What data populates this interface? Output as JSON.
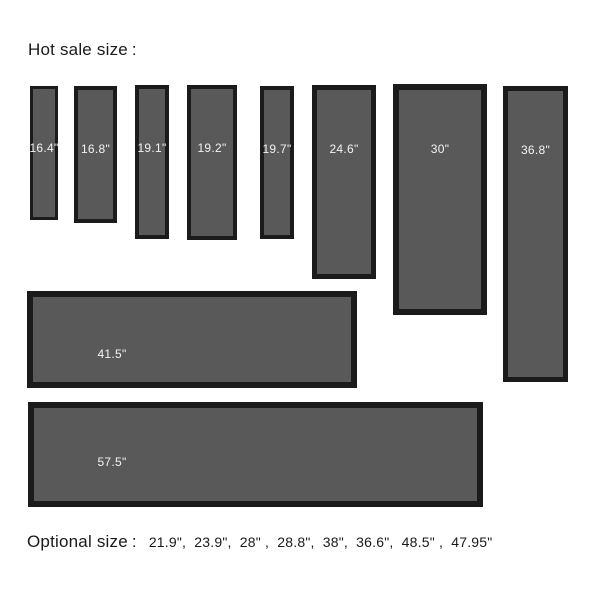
{
  "header": {
    "title": "Hot sale size",
    "colon": ":"
  },
  "panels": [
    {
      "label": "16.4\"",
      "orientation": "vertical"
    },
    {
      "label": "16.8\"",
      "orientation": "vertical"
    },
    {
      "label": "19.1\"",
      "orientation": "vertical"
    },
    {
      "label": "19.2\"",
      "orientation": "vertical"
    },
    {
      "label": "19.7\"",
      "orientation": "vertical"
    },
    {
      "label": "24.6\"",
      "orientation": "vertical"
    },
    {
      "label": "30\"",
      "orientation": "vertical"
    },
    {
      "label": "36.8\"",
      "orientation": "vertical"
    },
    {
      "label": "41.5\"",
      "orientation": "horizontal"
    },
    {
      "label": "57.5\"",
      "orientation": "horizontal"
    }
  ],
  "footer": {
    "title": "Optional size",
    "colon": ":",
    "sizes_list": "21.9\",  23.9\",  28\" ,  28.8\",  38\",  36.6\",  48.5\" ,  47.95\""
  },
  "colors": {
    "page_bg": "#ffffff",
    "text_color": "#1a1a1a",
    "panel_fill": "#595959",
    "panel_border": "#1b1b1b",
    "label_text": "#f2f2f2"
  }
}
